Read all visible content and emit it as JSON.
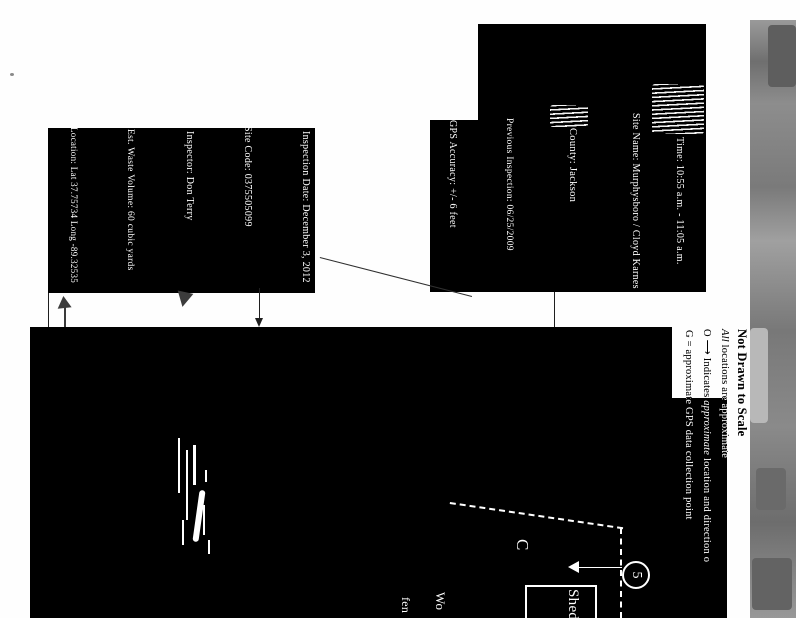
{
  "info_box_primary": {
    "lines": [
      "Inspection Date:  December 3, 2012",
      "Site Code:  0375505099",
      "Inspector:   Don Terry",
      "Est. Waste Volume:  60 cubic yards",
      "Location: Lat 37.75734    Long -89.32535"
    ]
  },
  "info_box_secondary": {
    "lines": [
      "Time:  10:55 a.m. - 11:05 a.m.",
      "Site Name:  Murphysboro / Cloyd Karnes",
      "County:  Jackson",
      "Previous Inspection:  06/25/2009",
      "GPS Accuracy:  +/- 6 feet"
    ]
  },
  "legend": {
    "title": "Not Drawn to Scale",
    "line2_italic": "All",
    "line2_rest": " locations are approximate",
    "line3_prefix": "O ",
    "line3_arrow": "⟶",
    "line3_mid": " Indicates ",
    "line3_italic": "approximate",
    "line3_rest": " location and direction o",
    "line4": "G = approximate GPS data collection point"
  },
  "map": {
    "structure_label": "C",
    "photo_point_number": "5",
    "shed_label": "Shed",
    "cut_label_line1": "Wo",
    "cut_label_line2": "fen"
  },
  "colors": {
    "ink": "#000000",
    "paper": "#fefefe",
    "scan_strip": "#828282",
    "map_line": "#ffffff"
  }
}
